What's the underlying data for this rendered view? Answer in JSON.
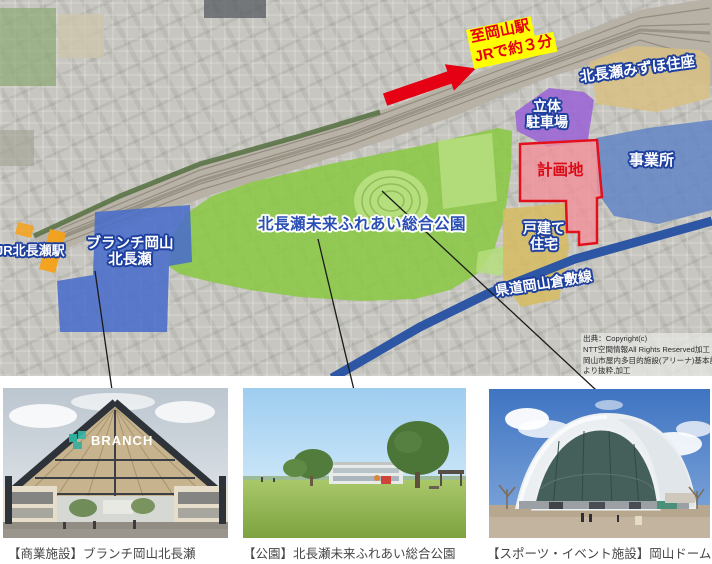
{
  "map": {
    "access_note": {
      "line1": "至岡山駅",
      "line2": "JRで約３分"
    },
    "labels": {
      "station": "JR北長瀬駅",
      "branch_line1": "ブランチ岡山",
      "branch_line2": "北長瀬",
      "park": "北長瀬未来ふれあい総合公園",
      "parking_line1": "立体",
      "parking_line2": "駐車場",
      "mizuho": "北長瀬みずほ住座",
      "plan_site": "計画地",
      "office": "事業所",
      "houses_line1": "戸建て",
      "houses_line2": "住宅",
      "road": "県道岡山倉敷線"
    },
    "credit": {
      "line1": "出典：Copyright(c)",
      "line2": "NTT空間情報All Rights Reserved加工",
      "line3": "岡山市屋内多目的施設(アリーナ)基本計画",
      "line4": "より抜粋,加工"
    },
    "colors": {
      "plan_site_red": "#e3101c",
      "park_green": "#8cc848",
      "facility_blue": "#4a6dcb",
      "office_blue": "#6285c6",
      "parking_purple": "#9a64d4",
      "residence_tan": "#d8c083",
      "station_orange": "#f4a119",
      "road_blue": "#2d57a5",
      "note_yellow": "#ffff00",
      "note_red": "#e60012"
    }
  },
  "photos": [
    {
      "caption": "【商業施設】ブランチ岡山北長瀬",
      "sign_text": "BRANCH"
    },
    {
      "caption": "【公園】北長瀬未来ふれあい総合公園"
    },
    {
      "caption": "【スポーツ・イベント施設】岡山ドーム"
    }
  ]
}
